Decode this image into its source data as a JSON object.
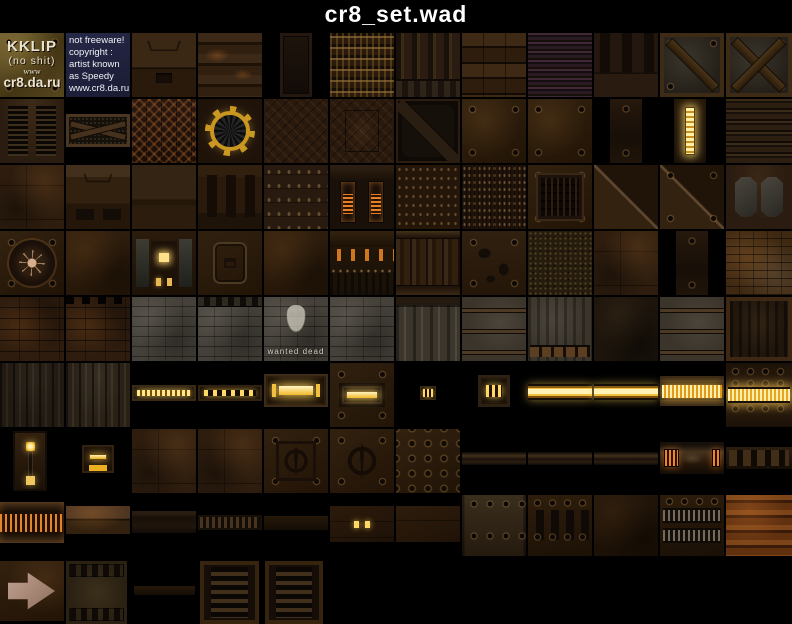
{
  "title": "cr8_set.wad",
  "colors": {
    "background": "#000000",
    "title_text": "#ffffff",
    "accent_gold": "#f2c040",
    "glow_orange": "#f08428",
    "base_brown": "#2c1b0d",
    "brick_gray": "#45413a",
    "copyright_bg": "#232543"
  },
  "tiles": [
    {
      "n": "tile-kklip-logo",
      "c": "tex-logo",
      "x": 0,
      "y": 33,
      "w": 64,
      "h": 64,
      "lines": [
        "KKLIP",
        "(no shit)",
        "www",
        "cr8.da.ru"
      ]
    },
    {
      "n": "tile-copyright-note",
      "c": "tex-copyright",
      "x": 66,
      "y": 33,
      "w": 64,
      "h": 64,
      "lines": [
        "not freeware!",
        "copyright :",
        "artist known",
        "as Speedy",
        "www.cr8.da.ru"
      ]
    },
    {
      "n": "tile-trapezoid-wall",
      "c": "tex-wall-trap",
      "x": 132,
      "y": 33,
      "w": 64,
      "h": 64
    },
    {
      "n": "tile-rust-band-wall",
      "c": "tex-rust-rows",
      "x": 198,
      "y": 33,
      "w": 64,
      "h": 64
    },
    {
      "n": "tile-narrow-door",
      "c": "tex-door-narrow",
      "x": 280,
      "y": 33,
      "w": 32,
      "h": 64
    },
    {
      "n": "tile-grate-ladder",
      "c": "tex-grate",
      "x": 330,
      "y": 33,
      "w": 64,
      "h": 64
    },
    {
      "n": "tile-ribbed-wall",
      "c": "tex-ribs-v",
      "x": 396,
      "y": 33,
      "w": 64,
      "h": 64
    },
    {
      "n": "tile-panel-row-wall",
      "c": "tex-panel-rows",
      "x": 462,
      "y": 33,
      "w": 64,
      "h": 64
    },
    {
      "n": "tile-striped-metal",
      "c": "tex-stripes-h",
      "x": 528,
      "y": 33,
      "w": 64,
      "h": 64
    },
    {
      "n": "tile-pillar-slot-wall",
      "c": "tex-pillars",
      "x": 594,
      "y": 33,
      "w": 64,
      "h": 64
    },
    {
      "n": "tile-crate-single-brace",
      "c": "tex-crate",
      "x": 660,
      "y": 33,
      "w": 64,
      "h": 64
    },
    {
      "n": "tile-crate-cross-brace",
      "c": "tex-crate x",
      "x": 726,
      "y": 33,
      "w": 66,
      "h": 64
    },
    {
      "n": "tile-double-vent-wall",
      "c": "tex-vents2",
      "x": 0,
      "y": 99,
      "w": 64,
      "h": 64
    },
    {
      "n": "tile-braced-fence",
      "c": "tex-fence",
      "x": 66,
      "y": 114,
      "w": 64,
      "h": 33
    },
    {
      "n": "tile-zigzag-plate",
      "c": "tex-zigzag",
      "x": 132,
      "y": 99,
      "w": 64,
      "h": 64
    },
    {
      "n": "tile-cog-fan-vent",
      "c": "tex-fan",
      "x": 198,
      "y": 99,
      "w": 64,
      "h": 64
    },
    {
      "n": "tile-crosshatch-plate",
      "c": "tex-xhatch",
      "x": 264,
      "y": 99,
      "w": 64,
      "h": 64
    },
    {
      "n": "tile-crosshatch-panel-plate",
      "c": "tex-xhatch-panel",
      "x": 330,
      "y": 99,
      "w": 64,
      "h": 64
    },
    {
      "n": "tile-hazard-diagonal-door",
      "c": "tex-hazard",
      "x": 396,
      "y": 99,
      "w": 64,
      "h": 64
    },
    {
      "n": "tile-bolted-plate-a",
      "c": "tex-plate-bolts",
      "x": 462,
      "y": 99,
      "w": 64,
      "h": 64
    },
    {
      "n": "tile-bolted-plate-b",
      "c": "tex-plate-bolts",
      "x": 528,
      "y": 99,
      "w": 64,
      "h": 64
    },
    {
      "n": "tile-narrow-bolted-strip",
      "c": "tex-strip-dark",
      "x": 610,
      "y": 99,
      "w": 32,
      "h": 64
    },
    {
      "n": "tile-narrow-light-strip",
      "c": "tex-strip-light",
      "x": 674,
      "y": 99,
      "w": 32,
      "h": 64
    },
    {
      "n": "tile-banded-metal-wall",
      "c": "tex-metal-h",
      "x": 726,
      "y": 99,
      "w": 66,
      "h": 64
    },
    {
      "n": "tile-patched-plate-a",
      "c": "tex-patch",
      "x": 0,
      "y": 165,
      "w": 64,
      "h": 64
    },
    {
      "n": "tile-slotted-trapezoid-wall",
      "c": "tex-wall-slots2",
      "x": 66,
      "y": 165,
      "w": 64,
      "h": 64
    },
    {
      "n": "tile-seam-band-wall",
      "c": "tex-wall-band",
      "x": 132,
      "y": 165,
      "w": 64,
      "h": 64
    },
    {
      "n": "tile-vertical-slot-wall",
      "c": "tex-slots-v",
      "x": 198,
      "y": 165,
      "w": 64,
      "h": 64
    },
    {
      "n": "tile-riveted-rows-wall",
      "c": "tex-rivet-rows",
      "x": 264,
      "y": 165,
      "w": 64,
      "h": 64
    },
    {
      "n": "tile-coil-pillar-wall",
      "c": "tex-coils",
      "x": 330,
      "y": 165,
      "w": 64,
      "h": 64
    },
    {
      "n": "tile-dense-rivet-wall",
      "c": "tex-rivets-dense",
      "x": 396,
      "y": 165,
      "w": 64,
      "h": 64
    },
    {
      "n": "tile-mesh-wall",
      "c": "tex-mesh",
      "x": 462,
      "y": 165,
      "w": 64,
      "h": 64
    },
    {
      "n": "tile-framed-vent-plate",
      "c": "tex-vent-frame",
      "x": 528,
      "y": 165,
      "w": 64,
      "h": 64
    },
    {
      "n": "tile-diagonal-seam-plate-a",
      "c": "tex-diag-seam",
      "x": 594,
      "y": 165,
      "w": 64,
      "h": 64
    },
    {
      "n": "tile-diagonal-seam-plate-b",
      "c": "tex-diag-seam b",
      "x": 660,
      "y": 165,
      "w": 64,
      "h": 64
    },
    {
      "n": "tile-octagon-recess-wall",
      "c": "tex-oct-recess",
      "x": 726,
      "y": 165,
      "w": 66,
      "h": 64
    },
    {
      "n": "tile-spider-emblem-plate",
      "c": "tex-spider",
      "x": 0,
      "y": 231,
      "w": 64,
      "h": 64
    },
    {
      "n": "tile-plain-rust-plate-a",
      "c": "tex-plain",
      "x": 66,
      "y": 231,
      "w": 64,
      "h": 64
    },
    {
      "n": "tile-light-window-panel",
      "c": "tex-panel-window",
      "x": 132,
      "y": 231,
      "w": 64,
      "h": 64
    },
    {
      "n": "tile-octagon-frame-plate",
      "c": "tex-octframe",
      "x": 198,
      "y": 231,
      "w": 64,
      "h": 64
    },
    {
      "n": "tile-plain-rust-plate-b",
      "c": "tex-plain",
      "x": 264,
      "y": 231,
      "w": 64,
      "h": 64
    },
    {
      "n": "tile-orange-slot-band",
      "c": "tex-slotband",
      "x": 330,
      "y": 231,
      "w": 64,
      "h": 64
    },
    {
      "n": "tile-pipe-column-wall",
      "c": "tex-pipecols",
      "x": 396,
      "y": 231,
      "w": 64,
      "h": 64
    },
    {
      "n": "tile-debris-bolted-plate",
      "c": "tex-debris",
      "x": 462,
      "y": 231,
      "w": 64,
      "h": 64
    },
    {
      "n": "tile-speckled-ground",
      "c": "tex-speckle",
      "x": 528,
      "y": 231,
      "w": 64,
      "h": 64
    },
    {
      "n": "tile-patched-plate-b",
      "c": "tex-patch",
      "x": 594,
      "y": 231,
      "w": 64,
      "h": 64
    },
    {
      "n": "tile-narrow-plate",
      "c": "tex-strip-dark",
      "x": 676,
      "y": 231,
      "w": 32,
      "h": 64
    },
    {
      "n": "tile-rust-brick-wall",
      "c": "tex-brick-rust",
      "x": 726,
      "y": 231,
      "w": 66,
      "h": 64
    },
    {
      "n": "tile-dark-brick-wall",
      "c": "tex-brick-dark",
      "x": 0,
      "y": 297,
      "w": 64,
      "h": 64
    },
    {
      "n": "tile-crenellated-brick-wall",
      "c": "tex-brick-crenel",
      "x": 66,
      "y": 297,
      "w": 64,
      "h": 64
    },
    {
      "n": "tile-gray-brick-wall-a",
      "c": "tex-brick-gray",
      "x": 132,
      "y": 297,
      "w": 64,
      "h": 64
    },
    {
      "n": "tile-banded-gray-brick-wall",
      "c": "tex-brick-gray-band",
      "x": 198,
      "y": 297,
      "w": 64,
      "h": 64
    },
    {
      "n": "tile-graffiti-brick-wall",
      "c": "tex-brick-graffiti",
      "x": 264,
      "y": 297,
      "w": 64,
      "h": 64,
      "lines": [
        "wanted dead"
      ]
    },
    {
      "n": "tile-gray-brick-wall-b",
      "c": "tex-brick-gray",
      "x": 330,
      "y": 297,
      "w": 64,
      "h": 64
    },
    {
      "n": "tile-streaked-concrete-wall",
      "c": "tex-conc-streak",
      "x": 396,
      "y": 297,
      "w": 64,
      "h": 64
    },
    {
      "n": "tile-railed-concrete-wall-a",
      "c": "tex-conc-rails",
      "x": 462,
      "y": 297,
      "w": 64,
      "h": 64
    },
    {
      "n": "tile-slatted-concrete-wall",
      "c": "tex-conc-slats",
      "x": 528,
      "y": 297,
      "w": 64,
      "h": 64
    },
    {
      "n": "tile-dark-mottled-wall",
      "c": "tex-dark-mottle",
      "x": 594,
      "y": 297,
      "w": 64,
      "h": 64
    },
    {
      "n": "tile-railed-concrete-wall-b",
      "c": "tex-conc-rails",
      "x": 660,
      "y": 297,
      "w": 64,
      "h": 64
    },
    {
      "n": "tile-framed-grunge-wall",
      "c": "tex-framed-grunge",
      "x": 726,
      "y": 297,
      "w": 66,
      "h": 64
    },
    {
      "n": "tile-streaked-metal-a",
      "c": "tex-dark-streaks",
      "x": 0,
      "y": 363,
      "w": 64,
      "h": 64
    },
    {
      "n": "tile-streaked-metal-b",
      "c": "tex-dark-streaks lt",
      "x": 66,
      "y": 363,
      "w": 64,
      "h": 64
    },
    {
      "n": "tile-dashed-light-bar",
      "c": "tex-light-dashbar",
      "x": 132,
      "y": 385,
      "w": 64,
      "h": 16
    },
    {
      "n": "tile-dotted-light-bar",
      "c": "tex-light-dots",
      "x": 198,
      "y": 385,
      "w": 64,
      "h": 16
    },
    {
      "n": "tile-caged-light-box",
      "c": "tex-light-box",
      "x": 264,
      "y": 374,
      "w": 64,
      "h": 33
    },
    {
      "n": "tile-framed-light-plate",
      "c": "tex-light-plate",
      "x": 330,
      "y": 363,
      "w": 64,
      "h": 64
    },
    {
      "n": "tile-tiny-light",
      "c": "tex-light-tiny",
      "x": 420,
      "y": 386,
      "w": 16,
      "h": 14
    },
    {
      "n": "tile-small-caged-light",
      "c": "tex-light-small",
      "x": 478,
      "y": 375,
      "w": 32,
      "h": 32
    },
    {
      "n": "tile-light-beam-a",
      "c": "tex-beam",
      "x": 528,
      "y": 384,
      "w": 64,
      "h": 16
    },
    {
      "n": "tile-light-beam-b",
      "c": "tex-beam",
      "x": 594,
      "y": 384,
      "w": 64,
      "h": 16
    },
    {
      "n": "tile-bordered-light-beam",
      "c": "tex-beam-border",
      "x": 660,
      "y": 376,
      "w": 64,
      "h": 30
    },
    {
      "n": "tile-bolted-light-beam-plate",
      "c": "tex-beam-bolted",
      "x": 726,
      "y": 363,
      "w": 66,
      "h": 64
    },
    {
      "n": "tile-narrow-light-panel",
      "c": "tex-light-narrow",
      "x": 13,
      "y": 431,
      "w": 34,
      "h": 60
    },
    {
      "n": "tile-double-bar-light",
      "c": "tex-light-2bars",
      "x": 82,
      "y": 445,
      "w": 32,
      "h": 28
    },
    {
      "n": "tile-patched-plate-c",
      "c": "tex-patch",
      "x": 132,
      "y": 429,
      "w": 64,
      "h": 64
    },
    {
      "n": "tile-patched-plate-d",
      "c": "tex-patch",
      "x": 198,
      "y": 429,
      "w": 64,
      "h": 64
    },
    {
      "n": "tile-framed-quake-plate",
      "c": "tex-quake framed",
      "x": 264,
      "y": 429,
      "w": 64,
      "h": 64
    },
    {
      "n": "tile-quake-emblem-plate",
      "c": "tex-quake",
      "x": 330,
      "y": 429,
      "w": 64,
      "h": 64
    },
    {
      "n": "tile-bolt-grid-plate",
      "c": "tex-boltgrid",
      "x": 396,
      "y": 429,
      "w": 64,
      "h": 64
    },
    {
      "n": "tile-thin-pipe-a",
      "c": "tex-pipe-thin",
      "x": 462,
      "y": 452,
      "w": 64,
      "h": 13
    },
    {
      "n": "tile-thin-pipe-b",
      "c": "tex-pipe-thin",
      "x": 528,
      "y": 452,
      "w": 64,
      "h": 13
    },
    {
      "n": "tile-thin-pipe-c",
      "c": "tex-pipe-thin",
      "x": 594,
      "y": 452,
      "w": 64,
      "h": 13
    },
    {
      "n": "tile-glowing-pipe-coupling",
      "c": "tex-pipe-coupling",
      "x": 660,
      "y": 442,
      "w": 64,
      "h": 32
    },
    {
      "n": "tile-slotted-pipe",
      "c": "tex-pipe-slotted",
      "x": 726,
      "y": 447,
      "w": 66,
      "h": 22
    },
    {
      "n": "tile-coil-strip",
      "c": "tex-coil-strip",
      "x": 0,
      "y": 502,
      "w": 64,
      "h": 41
    },
    {
      "n": "tile-rust-strip",
      "c": "tex-rust-strip",
      "x": 66,
      "y": 506,
      "w": 64,
      "h": 28
    },
    {
      "n": "tile-dark-strip",
      "c": "tex-dark-strip",
      "x": 132,
      "y": 511,
      "w": 64,
      "h": 22
    },
    {
      "n": "tile-dashed-strip",
      "c": "tex-dash-strip",
      "x": 198,
      "y": 515,
      "w": 64,
      "h": 15
    },
    {
      "n": "tile-thin-strip",
      "c": "tex-plain-strip",
      "x": 264,
      "y": 516,
      "w": 64,
      "h": 14
    },
    {
      "n": "tile-indicator-light-plate",
      "c": "tex-dot-plate",
      "x": 330,
      "y": 506,
      "w": 64,
      "h": 36
    },
    {
      "n": "tile-seamed-plate",
      "c": "tex-seam-plate",
      "x": 396,
      "y": 506,
      "w": 64,
      "h": 36
    },
    {
      "n": "tile-bolted-wall-plate",
      "c": "tex-plate-tb",
      "x": 462,
      "y": 495,
      "w": 64,
      "h": 61
    },
    {
      "n": "tile-slotted-bolt-plate",
      "c": "tex-plate-slots4",
      "x": 528,
      "y": 495,
      "w": 64,
      "h": 61
    },
    {
      "n": "tile-dark-plate",
      "c": "tex-plain dk",
      "x": 594,
      "y": 495,
      "w": 64,
      "h": 61
    },
    {
      "n": "tile-ribbed-coupling-plate",
      "c": "tex-coupling-plate",
      "x": 660,
      "y": 495,
      "w": 64,
      "h": 61
    },
    {
      "n": "tile-rust-banded-pipe",
      "c": "tex-rust-bands",
      "x": 726,
      "y": 495,
      "w": 66,
      "h": 61
    },
    {
      "n": "tile-arrow-sign",
      "c": "tex-arrow",
      "x": 0,
      "y": 561,
      "w": 64,
      "h": 60
    },
    {
      "n": "tile-slot-band-block",
      "c": "tex-slotband-tile",
      "x": 66,
      "y": 561,
      "w": 61,
      "h": 63
    },
    {
      "n": "tile-thin-pipe-d",
      "c": "tex-plain-strip",
      "x": 134,
      "y": 586,
      "w": 61,
      "h": 9
    },
    {
      "n": "tile-tall-vent-grille-a",
      "c": "tex-vent-tall",
      "x": 200,
      "y": 561,
      "w": 59,
      "h": 63
    },
    {
      "n": "tile-tall-vent-grille-b",
      "c": "tex-vent-tall",
      "x": 265,
      "y": 561,
      "w": 58,
      "h": 63
    }
  ]
}
